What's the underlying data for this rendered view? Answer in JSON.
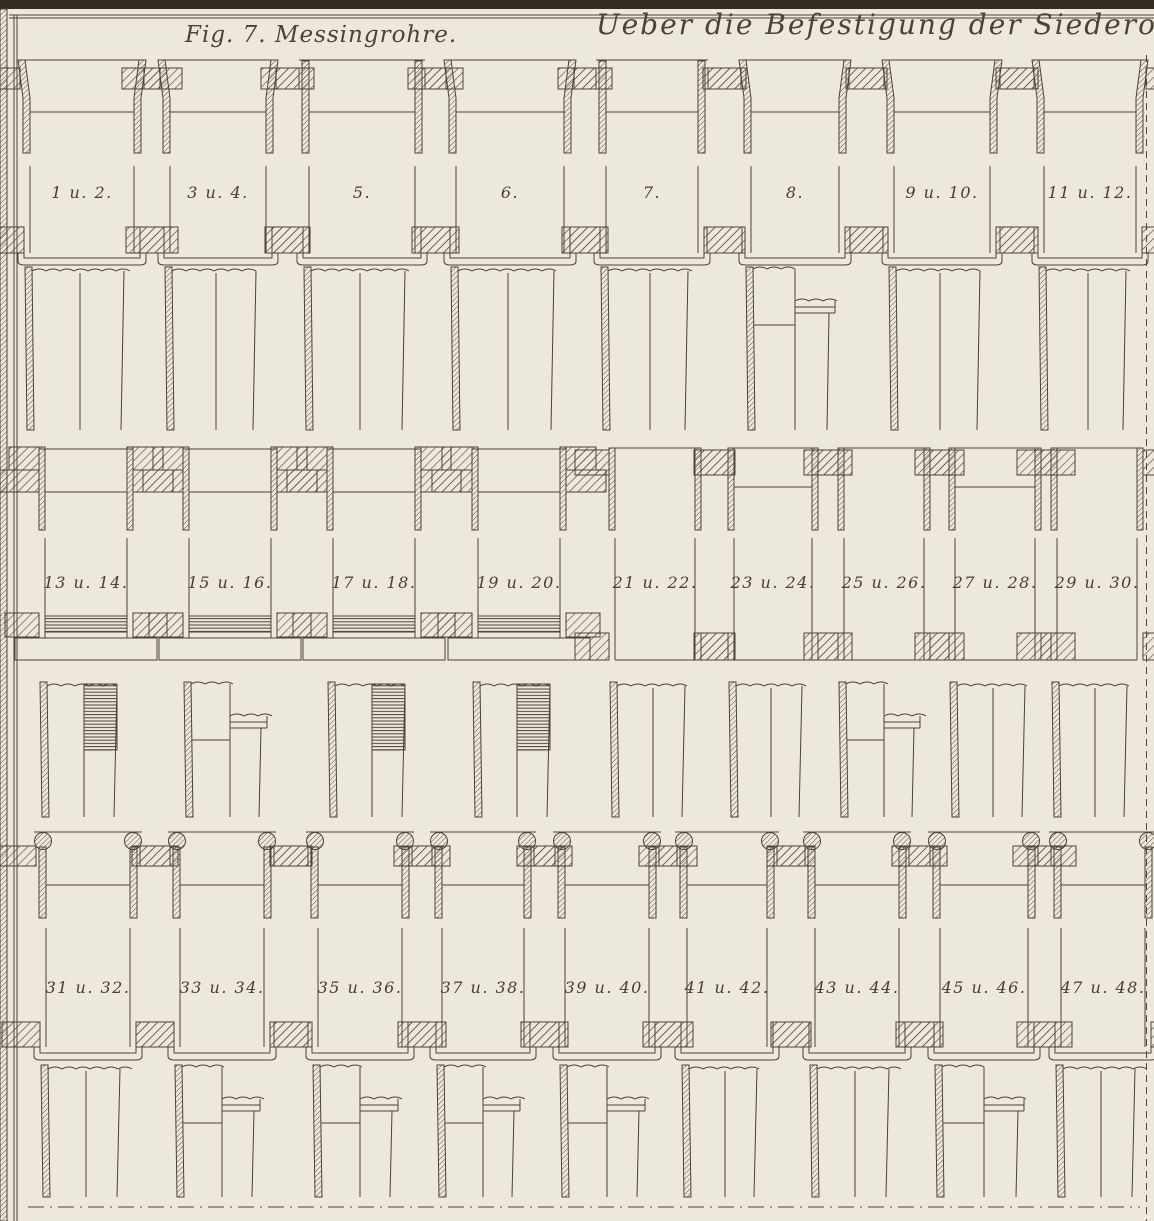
{
  "page": {
    "background": "#ece8db",
    "ink": "#4a4337",
    "frame": "#322d24",
    "title": "Ueber die Befestigung der Siederohre in der",
    "fig_caption": "Fig. 7. Messingrohre."
  },
  "figure": {
    "bands": [
      {
        "name": "band-1",
        "style": "band1",
        "labels": [
          "1 u. 2.",
          "3 u. 4.",
          "5.",
          "6.",
          "7.",
          "8.",
          "9 u. 10.",
          "11 u. 12."
        ],
        "centers": [
          82,
          218,
          362,
          510,
          652,
          795,
          942,
          1090
        ],
        "half_widths": [
          52,
          48,
          53,
          54,
          46,
          44,
          48,
          46
        ],
        "top_variants": [
          "flared",
          "flared",
          "straight",
          "flared",
          "straight",
          "flared",
          "flared",
          "flared"
        ],
        "shank_variants": [
          "plain",
          "plain",
          "plain",
          "plain",
          "plain",
          "collar",
          "plain",
          "plain"
        ],
        "geom": {
          "plate_y": 68,
          "plate_h": 21,
          "wall_bottom": 153,
          "mouth_y": 112,
          "gap_top": 166,
          "gap_bottom": 227,
          "label_y": 198,
          "bottom_y": 227,
          "bottom_h": 26,
          "flange_d": 12,
          "shank_top": 267,
          "shank_bottom": 430
        }
      },
      {
        "name": "band-2",
        "style": "band2",
        "labels": [
          "13 u. 14.",
          "15 u. 16.",
          "17 u. 18.",
          "19 u. 20.",
          "21 u. 22.",
          "23 u. 24.",
          "25 u. 26.",
          "27 u. 28.",
          "29 u. 30."
        ],
        "centers": [
          86,
          230,
          374,
          519,
          655,
          773,
          884,
          995,
          1097
        ],
        "half_widths": [
          41,
          41,
          41,
          41,
          40,
          39,
          40,
          40,
          40
        ],
        "top_variants": [
          "stepped",
          "stepped",
          "stepped",
          "stepped",
          "plain",
          "plain-mouth",
          "plain",
          "plain-mouth",
          "plain"
        ],
        "shank_variants": [
          "threaded",
          "collar",
          "threaded",
          "threaded",
          "plain",
          "plain",
          "collar",
          "plain",
          "plain"
        ],
        "geom": {
          "upper_y": 447,
          "upper_h": 23,
          "lower_h": 22,
          "wall_bottom": 530,
          "gap_top": 538,
          "label_y": 588,
          "stepped_bottom_y": 613,
          "stepped_bottom_h": 24,
          "base_h": 22,
          "plain_plate_y": 450,
          "plain_plate_h": 25,
          "plain_bottom_y": 633,
          "plain_bottom_h": 27,
          "shank_top": 682,
          "shank_bottom": 817
        }
      },
      {
        "name": "band-3",
        "style": "band3",
        "labels": [
          "31 u. 32.",
          "33 u. 34.",
          "35 u. 36.",
          "37 u. 38.",
          "39 u. 40.",
          "41 u. 42.",
          "43 u. 44.",
          "45 u. 46.",
          "47 u. 48."
        ],
        "centers": [
          88,
          222,
          360,
          483,
          607,
          727,
          857,
          984,
          1103
        ],
        "half_widths": [
          42,
          42,
          42,
          41,
          42,
          40,
          42,
          44,
          42
        ],
        "top_variants": [
          "bead",
          "bead",
          "bead",
          "bead",
          "bead",
          "bead",
          "bead",
          "bead",
          "bead"
        ],
        "shank_variants": [
          "plain",
          "collar",
          "collar",
          "collar",
          "collar",
          "plain",
          "plain",
          "collar",
          "plain"
        ],
        "geom": {
          "rim_y": 832,
          "bead_y": 841,
          "plate_y": 846,
          "plate_h": 20,
          "wall_bottom": 918,
          "mouth_y": 885,
          "gap_top": 928,
          "gap_bottom": 1022,
          "label_y": 993,
          "bottom_y": 1022,
          "bottom_h": 25,
          "flange_d": 13,
          "shank_top": 1065,
          "shank_bottom": 1197
        }
      }
    ]
  }
}
